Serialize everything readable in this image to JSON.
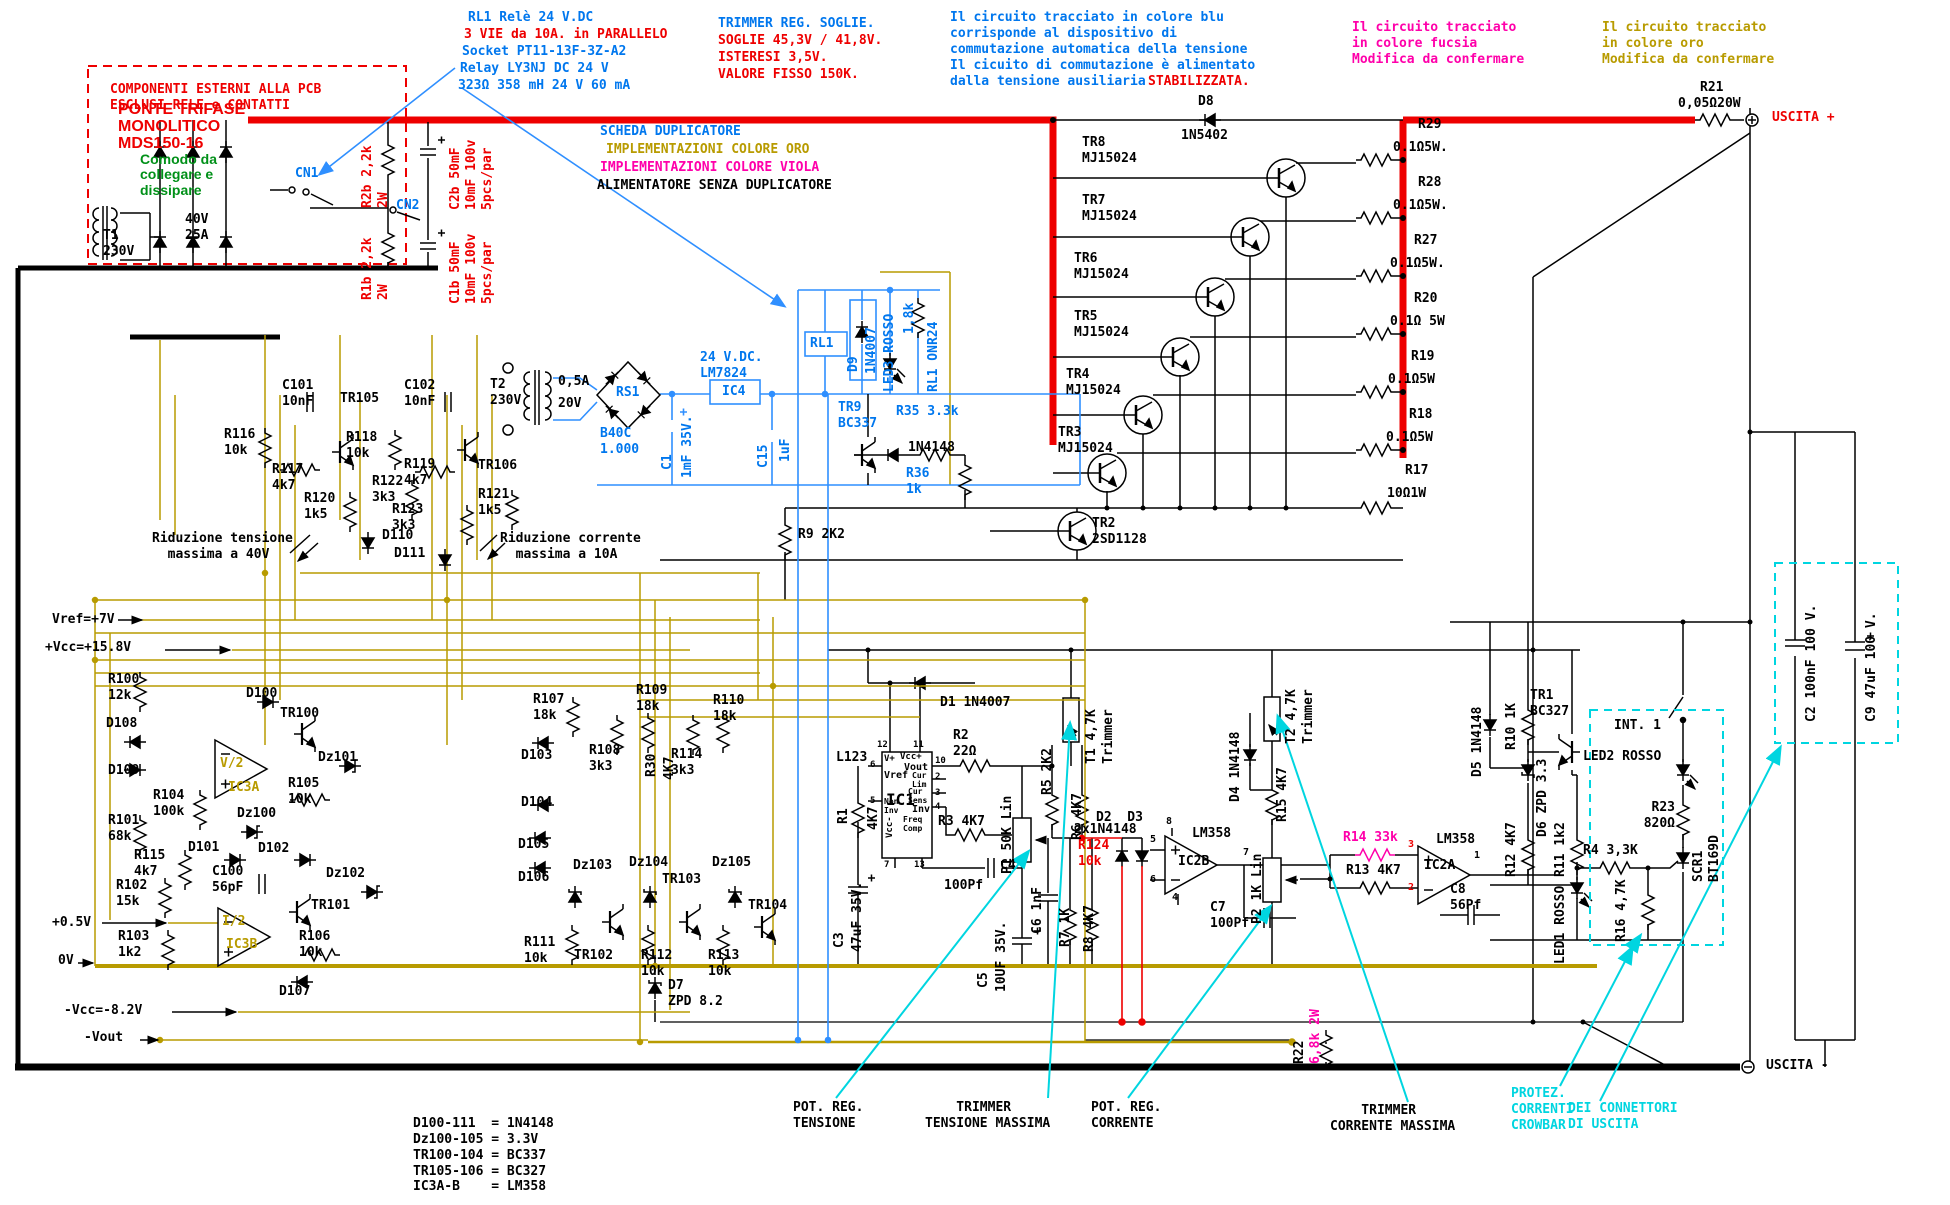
{
  "ann": {
    "rl1_1": "RL1 Relè 24 V.DC",
    "rl1_2": "3 VIE da 10A. in PARALLELO",
    "rl1_3": "Socket PT11-13F-3Z-A2",
    "rl1_4": "Relay LY3NJ DC 24 V",
    "rl1_5": "323Ω 358 mH 24 V 60 mA",
    "trim_1": "TRIMMER REG. SOGLIE.",
    "trim_2": "SOGLIE 45,3V / 41,8V.",
    "trim_3": "ISTERESI 3,5V.",
    "trim_4": "VALORE FISSO 150K.",
    "blue_block": "Il circuito tracciato in colore blu\ncorrisponde al dispositivo di\ncommutazione automatica della tensione\nIl cicuito di commutazione è alimentato",
    "blue_l5a": "dalla tensione ausiliaria",
    "blue_l5b": "STABILIZZATA.",
    "fucsia": "Il circuito tracciato\nin colore fucsia\nModifica da confermare",
    "oro": "Il circuito tracciato\nin colore oro\nModifica da confermare",
    "external": "COMPONENTI ESTERNI ALLA PCB\nESCLUSI RELE e CONTATTI",
    "ponte": "PONTE TRIFASE\nMONOLITICO\nMDS150-16",
    "comodo": "Comodo da\ncollegare e\ndissipare",
    "scheda_1": "SCHEDA DUPLICATORE",
    "scheda_2": "IMPLEMENTAZIONI COLORE ORO",
    "scheda_3": "IMPLEMENTAZIONI COLORE VIOLA",
    "scheda_4": "ALIMENTATORE SENZA DUPLICATORE",
    "riduz_t": "Riduzione tensione\n  massima a 40V",
    "riduz_c": "Riduzione corrente\n  massima a 10A",
    "pot_t": "POT. REG.\nTENSIONE",
    "trim_t": "    TRIMMER\nTENSIONE MASSIMA",
    "pot_c": "POT. REG.\nCORRENTE",
    "trim_c": "    TRIMMER\nCORRENTE MASSIMA",
    "protez": "PROTEZ.\nCORRENTI\nCROWBAR",
    "connettori": "DEI CONNETTORI\nDI USCITA",
    "legend": "D100-111  = 1N4148\nDz100-105 = 3.3V\nTR100-104 = BC337\nTR105-106 = BC327\nIC3A-B    = LM358"
  },
  "io": {
    "vref": "Vref=+7V",
    "vcc": "+Vcc=+15.8V",
    "v05": "+0.5V",
    "v0": "0V",
    "nvcc": "-Vcc=-8.2V",
    "nvout": "-Vout",
    "out_p": "USCITA +",
    "out_n": "USCITA -"
  },
  "cmp": {
    "t1": "T1\n230V",
    "t1s": "40V\n25A",
    "cn1": "CN1",
    "cn2": "CN2",
    "r2b": "R2b 2,2k\n2W",
    "r1b": "R1b 2,2k\n2W",
    "c2b": "C2b 50mF\n10mF 100v\n5pcs/par",
    "c1b": "C1b 50mF\n10mF 100v\n5pcs/par",
    "t2": "T2\n230V",
    "t2f": "0,5A",
    "t2s": "20V",
    "rs1": "RS1",
    "b40c": "B40C\n1.000",
    "c1": "C1",
    "c1v": "1mF 35V.",
    "ic4r": "24 V.DC.\nLM7824",
    "ic4": "IC4",
    "c15": "C15",
    "c15v": "1uF",
    "rl1": "RL1",
    "d9": "D9",
    "d9v": "1N4007",
    "led3": "LED3 ROSSO",
    "r1k8": "1,8k",
    "rl1on": "RL1 ONR24",
    "tr9": "TR9\nBC337",
    "r35": "R35 3.3k",
    "dtr9": "1N4148",
    "r36": "R36\n1k",
    "d8": "D8",
    "d8v": "1N5402",
    "tr8": "TR8\nMJ15024",
    "tr7": "TR7\nMJ15024",
    "tr6": "TR6\nMJ15024",
    "tr5": "TR5\nMJ15024",
    "tr4": "TR4\nMJ15024",
    "tr3": "TR3\nMJ15024",
    "tr2": "TR2\n2SD1128",
    "r29": "R29",
    "r29v": "0.1Ω5W.",
    "r28": "R28",
    "r28v": "0.1Ω5W.",
    "r27": "R27",
    "r27v": "0.1Ω5W.",
    "r20": "R20",
    "r20v": "0.1Ω 5W",
    "r19": "R19",
    "r19v": "0.1Ω5W",
    "r18": "R18",
    "r18v": "0.1Ω5W",
    "r17": "R17",
    "r17v": "10Ω1W",
    "r21": "R21",
    "r21v": "0,05Ω20W",
    "r9": "R9 2K2",
    "d1": "D1 1N4007",
    "c101": "C101\n10nF",
    "tr105": "TR105",
    "c102": "C102\n10nF",
    "r116": "R116\n10k",
    "r117": "R117\n4k7",
    "r118": "R118\n10k",
    "r119": "R119\n4k7",
    "tr106": "TR106",
    "r120": "R120\n1k5",
    "r122": "R122\n3k3",
    "r123": "R123\n3k3",
    "r121": "R121\n1k5",
    "d110": "D110",
    "d111": "D111",
    "r100": "R100\n12k",
    "d108": "D108",
    "d109": "D109",
    "r104": "R104\n100k",
    "r101": "R101\n68k",
    "r115": "R115\n4k7",
    "r102": "R102\n15k",
    "r103": "R103\n1k2",
    "d100": "D100",
    "tr100": "TR100",
    "v2": "V/2",
    "ic3a": "IC3A",
    "r105": "R105\n10k",
    "dz100": "Dz100",
    "dz101": "Dz101",
    "d101": "D101",
    "d102": "D102",
    "c100": "C100\n56pF",
    "i2": "I/2",
    "ic3b": "IC3B",
    "tr101": "TR101",
    "r106": "R106\n10k",
    "dz102": "Dz102",
    "d107": "D107",
    "r107": "R107\n18k",
    "r109": "R109\n18k",
    "r110": "R110\n18k",
    "d103": "D103",
    "r108": "R108\n3k3",
    "r114": "R114\n3k3",
    "d104": "D104",
    "d105": "D105",
    "d106": "D106",
    "dz103": "Dz103",
    "dz104": "Dz104",
    "dz105": "Dz105",
    "tr102": "TR102",
    "tr103": "TR103",
    "tr104": "TR104",
    "r111": "R111\n10k",
    "r112": "R112\n10k",
    "r113": "R113\n10k",
    "d7": "D7\nZPD 8.2",
    "l123": "L123",
    "ic1": "IC1",
    "r1": "R1",
    "r1v": "4K7",
    "r30": "R30",
    "r30v": "4K7",
    "r2": "R2\n22Ω",
    "r3": "R3 4K7",
    "c4": "C4",
    "c4v": "100Pf",
    "c3": "C3",
    "c3v": "47uF 35V.",
    "c5": "C5",
    "c5v": "10UF 35V.",
    "p1": "P1 50K Lin",
    "r5": "R5 2K2",
    "t1t": "T1 4,7K",
    "t1tl": "Trimmer",
    "r6": "R6 4K7",
    "c6": "C6 1nF",
    "r7": "R7 1K",
    "r8": "R8 4K7",
    "d2d3": "D2  D3",
    "dd23": "2x1N4148",
    "r124": "R124\n10k",
    "lm358b": "LM358",
    "ic2b": "IC2B",
    "c7": "C7\n100Pf",
    "d4": "D4 1N4148",
    "r15": "R15 4K7",
    "t2t": "T2 4,7K",
    "t2tl": "Trimmer",
    "p2": "P2 1K Lin",
    "r14": "R14 33k",
    "r13": "R13 4K7",
    "lm358a": "LM358",
    "ic2a": "IC2A",
    "c8": "C8\n56Pf",
    "d5": "D5 1N4148",
    "r10": "R10 1K",
    "tr1": "TR1\nBC327",
    "d6": "D6 ZPD 3.3",
    "r12": "R12 4K7",
    "r11": "R11 1k2",
    "led1": "LED1 ROSSO",
    "int1": "INT. 1",
    "led2": "LED2 ROSSO",
    "r23": "R23\n820Ω",
    "scr1": "SCR1\nBT169D",
    "r4": "R4 3,3K",
    "r16": "R16 4,7K",
    "c2": "C2 100nF 100 V.",
    "c9": "C9 47uF 100 V.",
    "r22": "R22",
    "r22v": "6,8k 2W"
  },
  "pin": {
    "p12": "12",
    "p11": "11",
    "p10": "10",
    "p6": "6",
    "p2": "2",
    "p3": "3",
    "p5": "5",
    "p4": "4",
    "p7": "7",
    "p13": "13",
    "vp": "V+",
    "vccp": "Vcc+",
    "vout": "Vout",
    "vref": "Vref",
    "curlim": "Cur\nLim",
    "cursens": "Cur\nSens",
    "noninv": "Non\nInv",
    "inv": "Inv",
    "vccm": "Vcc-",
    "freq": "Freq\nComp",
    "b8": "8",
    "b5": "5",
    "b6": "6",
    "b7": "7",
    "b4": "4",
    "a3": "3",
    "a2": "2",
    "a1": "1"
  },
  "colors": {
    "red": "#ee0000",
    "blue": "#0077ee",
    "gold": "#b89b00",
    "magenta": "#ff00aa",
    "cyan": "#00d5e0",
    "green": "#009018"
  }
}
